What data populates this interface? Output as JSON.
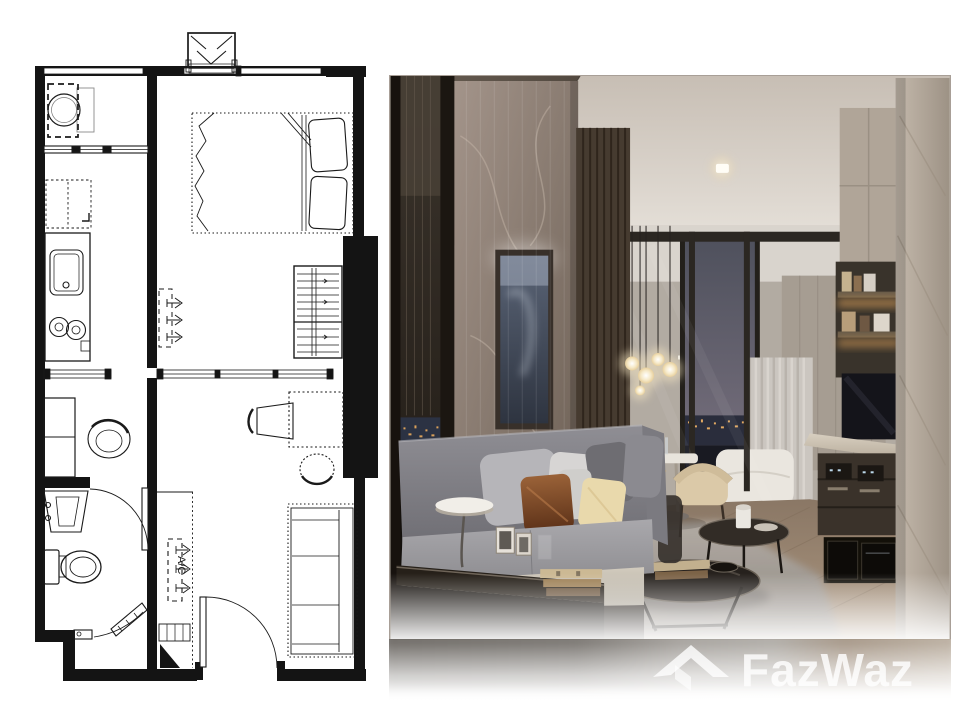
{
  "page": {
    "background": "#ffffff"
  },
  "floor_plan": {
    "ac_label": "A/C",
    "ink": "#1a1a1a",
    "fixtures": [
      "washing-machine",
      "refrigerator",
      "kitchen-counter",
      "sink",
      "stove",
      "double-bed",
      "wardrobe",
      "ac-ledge-unit",
      "ac-indoor-unit",
      "dressing-cabinet",
      "armchair",
      "vanity-sink",
      "toilet",
      "shower-door",
      "entrance-door",
      "desk",
      "dining-chairs",
      "sofa",
      "glass-partition",
      "window"
    ]
  },
  "photo": {
    "palette": {
      "ceiling": "#d8d3cc",
      "soffit": "#4a4138",
      "marble_wall": "#8d7e71",
      "wood_slats": "#473a2f",
      "window_frame": "#1d1813",
      "night_sky": "#565866",
      "city_lights": "#e0a95f",
      "bedroom_wall": "#b5aea5",
      "curtain": "#cbc6c0",
      "bed": "#eae6df",
      "dining_chair": "#d9c7a6",
      "sofa": "#8f8e93",
      "pillow_rust": "#8a5531",
      "pillow_cream": "#e8d8ab",
      "rug": "#9c968f",
      "floor_wood": "#97826c",
      "console": "#3b332b",
      "marble_column": "#bdb2a5",
      "lamp": "#f0ede7",
      "tv": "#141419"
    }
  },
  "watermark": {
    "text": "FazWaz",
    "color": "#ffffff",
    "logo": "roof-icon"
  }
}
